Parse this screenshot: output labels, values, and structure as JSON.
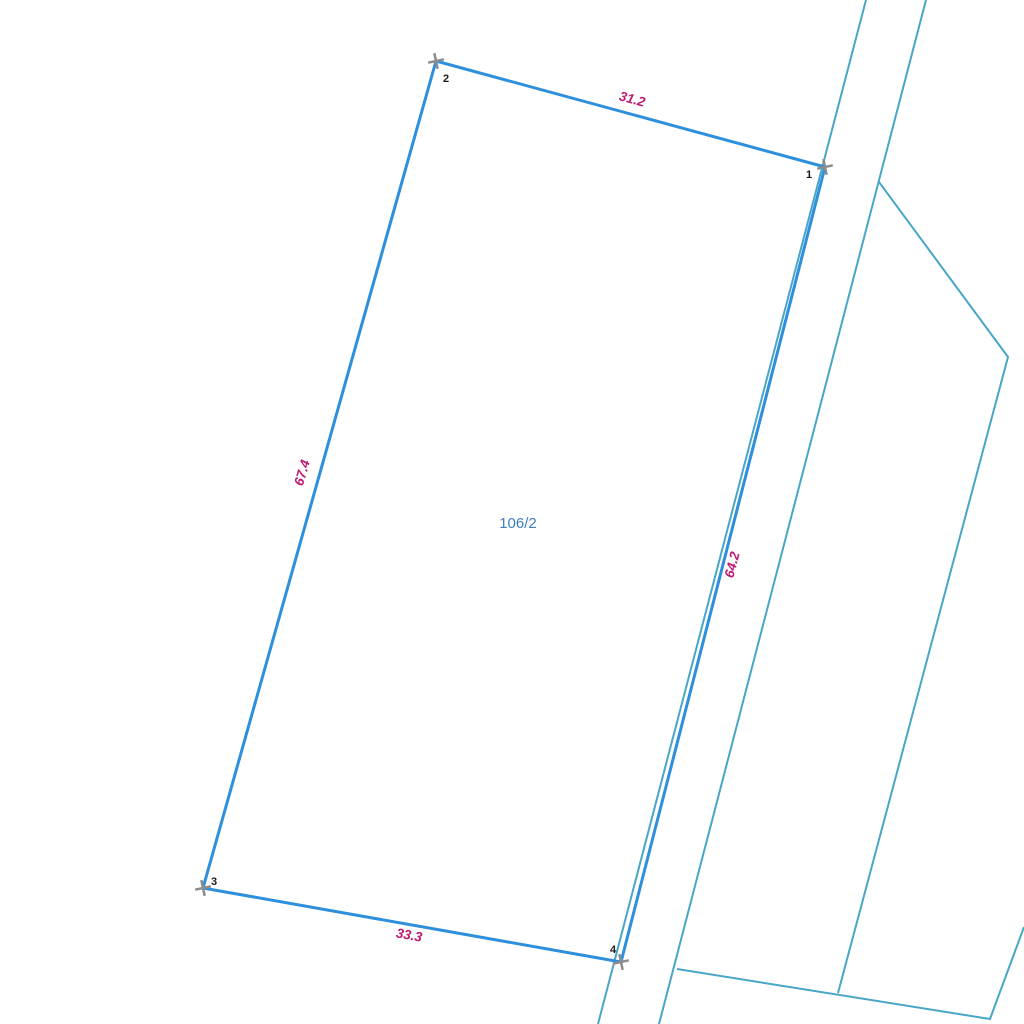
{
  "map": {
    "colors": {
      "background": "#FFFFFF",
      "parcel_boundary": "#2E90DC",
      "parcel_label": "#3D7EC1",
      "dimension_label": "#BE1A72",
      "adjacent_boundary": "#49A6C6",
      "vertex_marker": "#8C8C8C",
      "vertex_label": "#1A1A1A"
    },
    "parcel": {
      "label": "106/2",
      "label_pos": {
        "x": 518,
        "y": 524
      },
      "vertices": [
        {
          "id": "1",
          "x": 825,
          "y": 167,
          "label_x": 809,
          "label_y": 175
        },
        {
          "id": "2",
          "x": 436,
          "y": 61,
          "label_x": 446,
          "label_y": 79
        },
        {
          "id": "3",
          "x": 203,
          "y": 888,
          "label_x": 214,
          "label_y": 882
        },
        {
          "id": "4",
          "x": 621,
          "y": 962,
          "label_x": 613,
          "label_y": 950
        }
      ],
      "edges": [
        {
          "from": "2",
          "to": "1",
          "length": "31.2",
          "label_x": 632,
          "label_y": 100,
          "label_rotation": 15
        },
        {
          "from": "2",
          "to": "3",
          "length": "67.4",
          "label_x": 303,
          "label_y": 473,
          "label_rotation": -74
        },
        {
          "from": "1",
          "to": "4",
          "length": "64.2",
          "label_x": 733,
          "label_y": 565,
          "label_rotation": -76
        },
        {
          "from": "3",
          "to": "4",
          "length": "33.3",
          "label_x": 409,
          "label_y": 936,
          "label_rotation": 10
        }
      ]
    },
    "adjacent_lines": [
      {
        "name": "adjacent-boundary-line-1",
        "points": [
          [
            866,
            0
          ],
          [
            598,
            1024
          ]
        ]
      },
      {
        "name": "adjacent-boundary-line-2",
        "points": [
          [
            926,
            0
          ],
          [
            659,
            1024
          ]
        ]
      },
      {
        "name": "adjacent-boundary-line-3",
        "points": [
          [
            879,
            182
          ],
          [
            1008,
            357
          ],
          [
            838,
            993
          ]
        ]
      },
      {
        "name": "adjacent-boundary-line-4",
        "points": [
          [
            677,
            969
          ],
          [
            990,
            1019
          ],
          [
            1024,
            927
          ]
        ]
      }
    ],
    "marker": {
      "arm": 8,
      "rotation": -12,
      "stroke_width": 2.5
    },
    "line_widths": {
      "parcel": 3,
      "adjacent": 2
    }
  }
}
